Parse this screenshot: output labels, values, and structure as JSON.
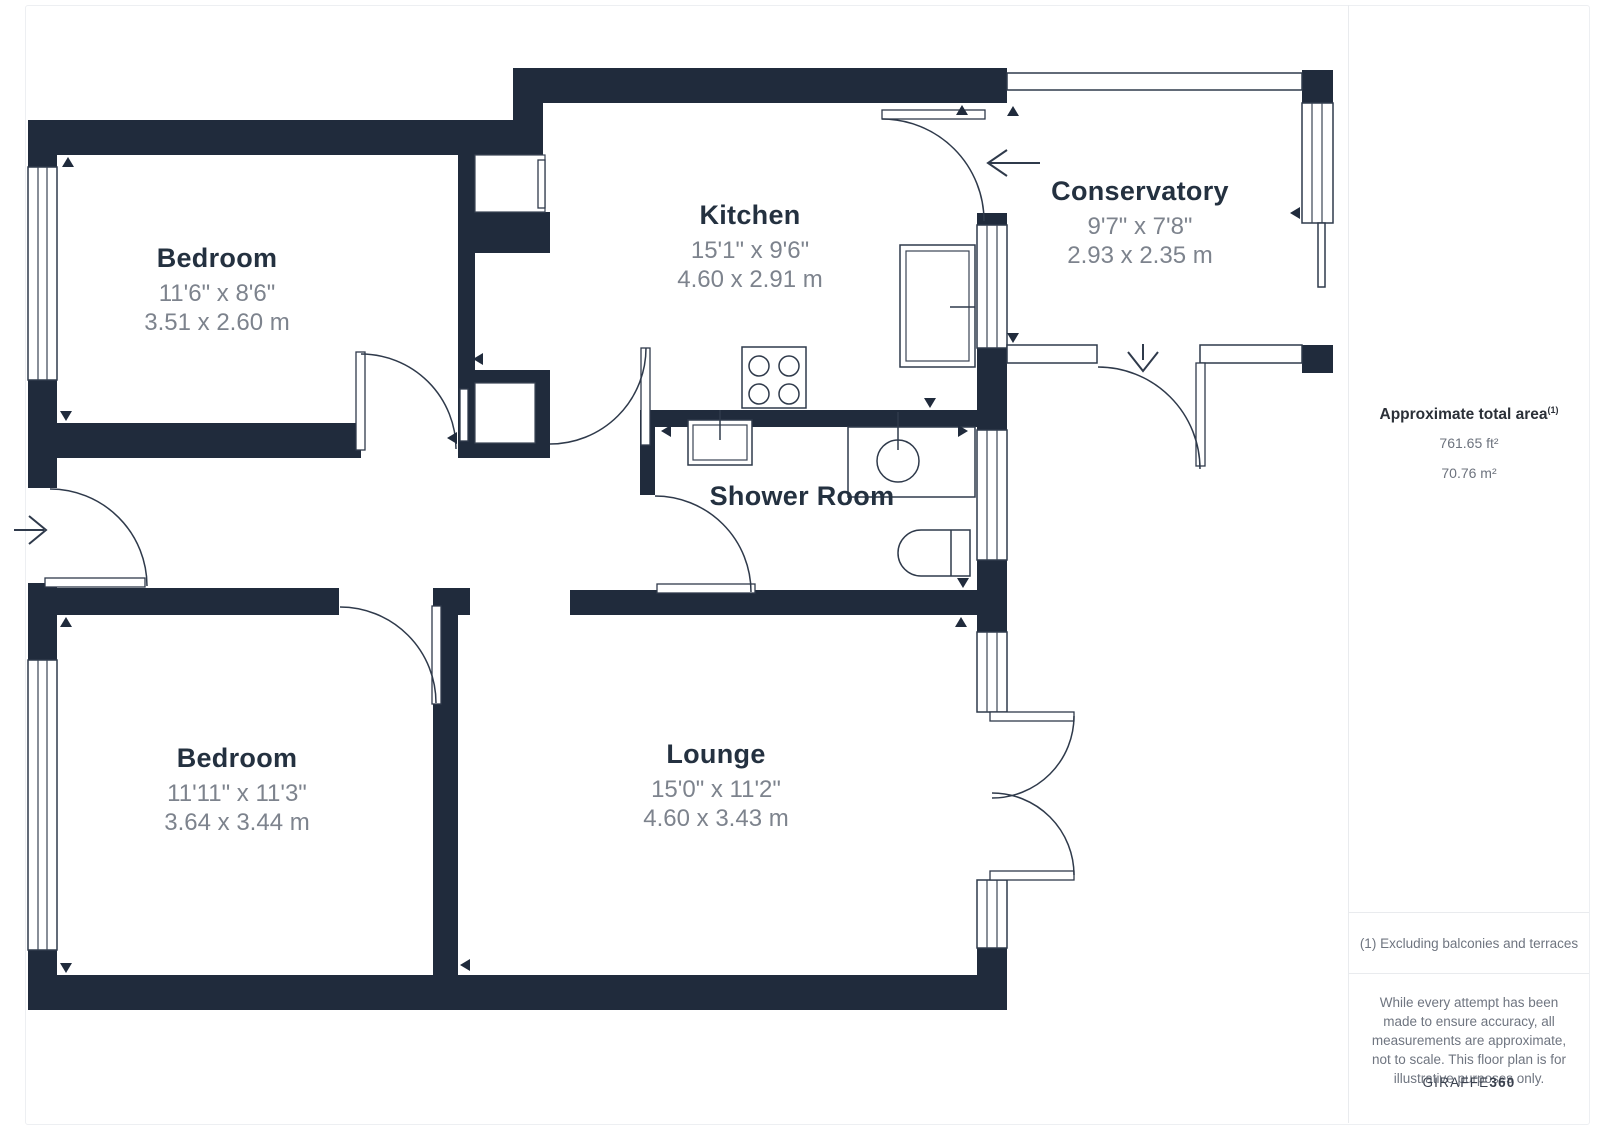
{
  "rooms": [
    {
      "name": "Bedroom",
      "imperial": "11'6\" x 8'6\"",
      "metric": "3.51 x 2.60 m"
    },
    {
      "name": "Kitchen",
      "imperial": "15'1\" x 9'6\"",
      "metric": "4.60 x 2.91 m"
    },
    {
      "name": "Conservatory",
      "imperial": "9'7\" x 7'8\"",
      "metric": "2.93 x 2.35 m"
    },
    {
      "name": "Shower Room"
    },
    {
      "name": "Bedroom",
      "imperial": "11'11\" x 11'3\"",
      "metric": "3.64 x 3.44 m"
    },
    {
      "name": "Lounge",
      "imperial": "15'0\" x 11'2\"",
      "metric": "4.60 x 3.43 m"
    }
  ],
  "sidebar": {
    "area_title": "Approximate total area",
    "area_footnote_marker": "(1)",
    "area_ft": "761.65 ft²",
    "area_m": "70.76 m²",
    "footnote": "(1) Excluding balconies and terraces",
    "disclaimer": "While every attempt has been made to ensure accuracy, all measurements are approximate, not to scale. This floor plan is for illustrative purposes only.",
    "brand_name": "GIRAFFE",
    "brand_suffix": "360"
  },
  "colors": {
    "wall": "#202b3c",
    "line": "#2f3a4b",
    "room_name": "#243140",
    "dimension_text": "#7d838d",
    "sidebar_text": "#6f7580",
    "divider": "#e9ebee"
  }
}
